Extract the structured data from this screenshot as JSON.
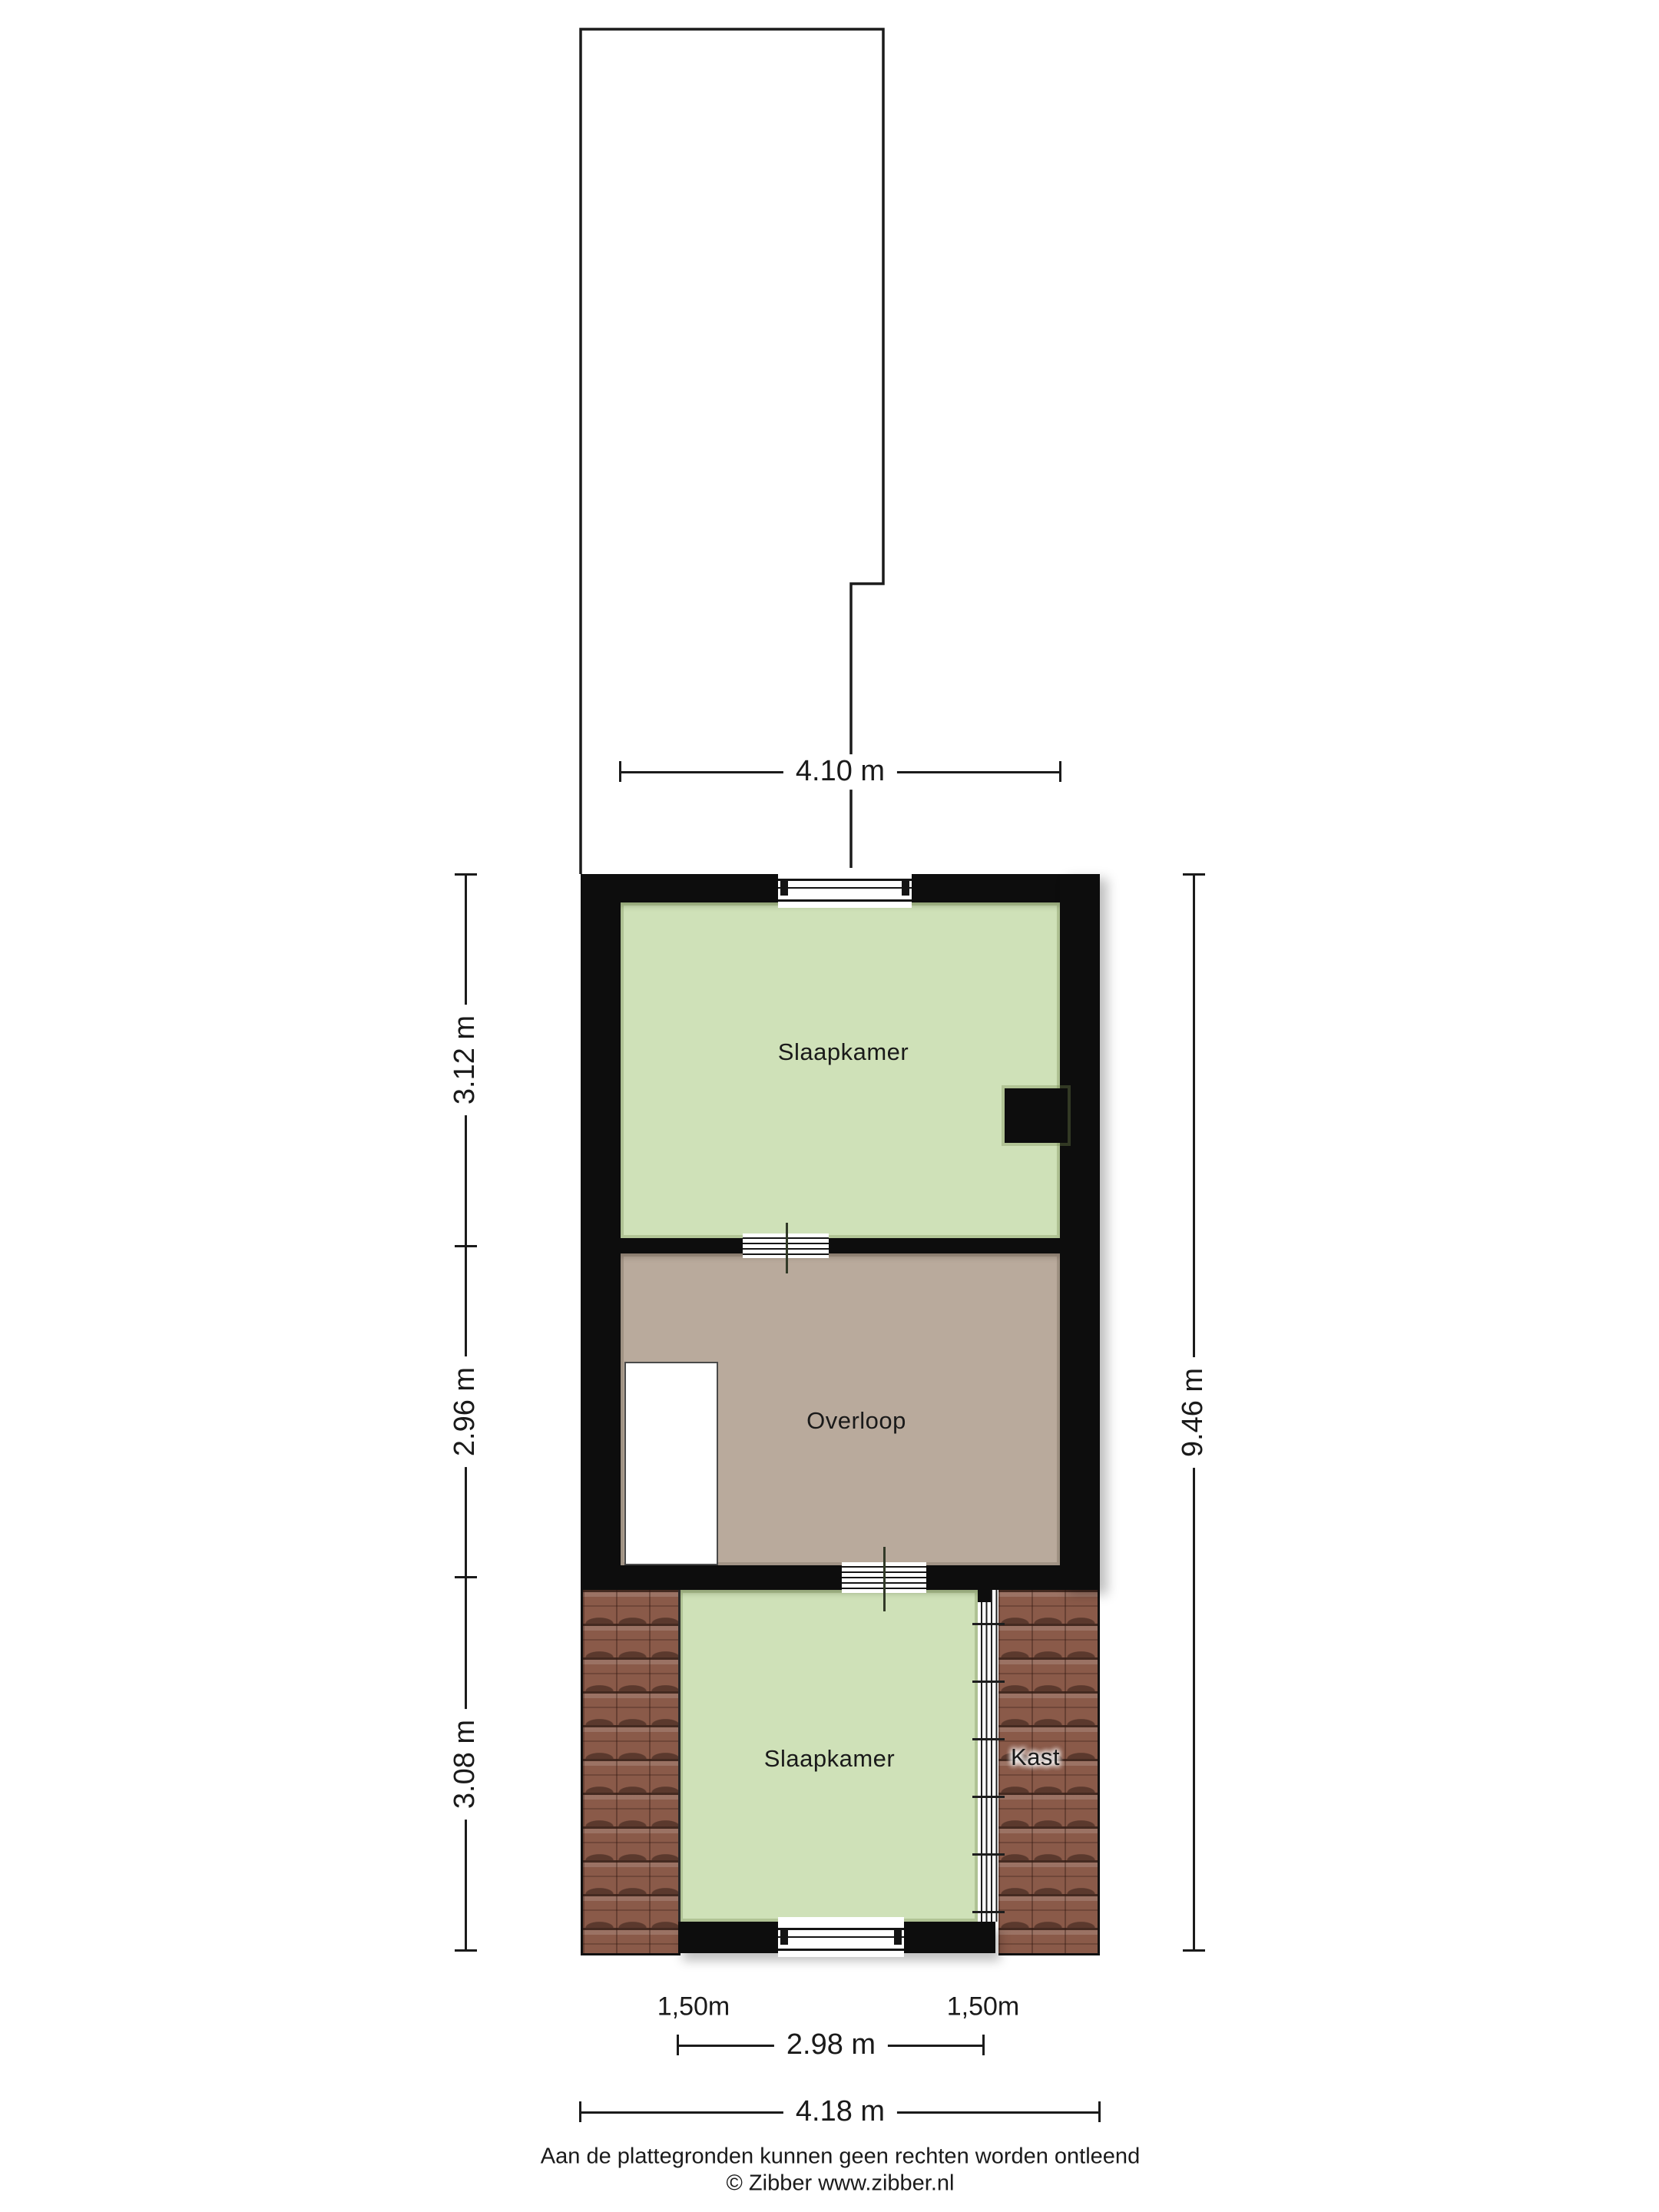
{
  "rooms": {
    "bedroom_top": {
      "label": "Slaapkamer"
    },
    "landing": {
      "label": "Overloop"
    },
    "bedroom_bottom": {
      "label": "Slaapkamer"
    },
    "closet": {
      "label": "Kast"
    }
  },
  "dimensions": {
    "top_width": "4.10 m",
    "left_top": "3.12 m",
    "left_middle": "2.96 m",
    "left_bottom": "3.08 m",
    "right_total": "9.46 m",
    "bottom_room_width": "2.98 m",
    "bottom_total_width": "4.18 m",
    "knee_wall_left": "1,50m",
    "knee_wall_right": "1,50m"
  },
  "footer": {
    "disclaimer": "Aan de plattegronden kunnen geen rechten worden ontleend",
    "copyright": "© Zibber www.zibber.nl"
  },
  "colors": {
    "wall": "#0d0d0d",
    "bedroom_fill": "#cfe1b8",
    "landing_fill": "#b9aa9c",
    "roof_tile": "#8a5a49",
    "line": "#1b1b1b",
    "label_text": "#1a1a1a"
  }
}
